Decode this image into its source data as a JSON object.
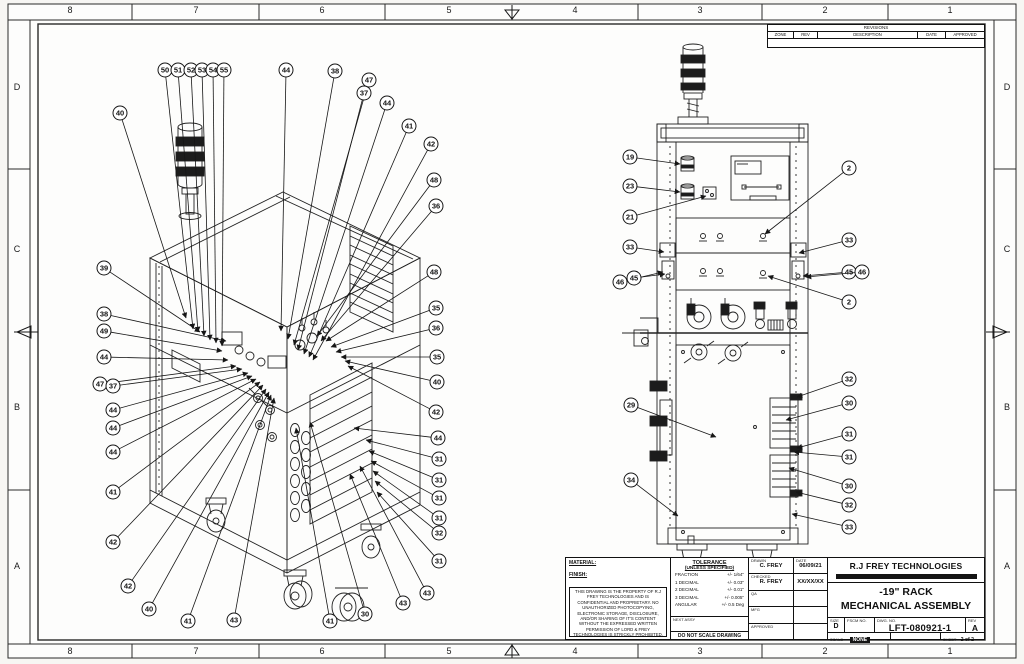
{
  "page": {
    "background": "#f7f6f3",
    "sheet_background": "#fdfdfc",
    "line_color": "#1b1b1b"
  },
  "border": {
    "top_zones": [
      "8",
      "7",
      "6",
      "5",
      "4",
      "3",
      "2",
      "1"
    ],
    "bottom_zones": [
      "8",
      "7",
      "6",
      "5",
      "4",
      "3",
      "2",
      "1"
    ],
    "left_rows": [
      "D",
      "C",
      "B",
      "A"
    ],
    "right_rows": [
      "D",
      "C",
      "B",
      "A"
    ]
  },
  "revisions": {
    "title": "REVISIONS",
    "columns": [
      "ZONE",
      "REV",
      "DESCRIPTION",
      "DATE",
      "APPROVED"
    ]
  },
  "title_block": {
    "material_label": "MATERIAL:",
    "finish_label": "FINISH:",
    "disclaimer": "THIS DRAWING IS THE PROPERTY OF R.J FREY TECHNOLOGIES AND IS CONFIDENTIAL AND PROPRIETARY. NO UNAUTHORIZED PHOTOCOPYING, ELECTRONIC STORAGE, DISCLOSURE, AND/OR SHARING OF IT'S CONTENT WITHOUT THE EXPRESSED WRITTEN PERMISSION OF LORD & FREY TECHNOLOGIES IS STRICKLY PROHIBITED.",
    "tolerance": {
      "title": "TOLERANCE",
      "subtitle": "(UNLESS SPECIFIED)",
      "rows": [
        {
          "name": "FRACTION",
          "value": "+/-  1/64\""
        },
        {
          "name": "1 DECIMAL",
          "value": "+/-  0.03\""
        },
        {
          "name": "2 DECIMAL",
          "value": "+/-  0.01\""
        },
        {
          "name": "3 DECIMAL",
          "value": "+/-  0.005\""
        },
        {
          "name": "ANGULAR",
          "value": "+/- 0.5 Deg"
        }
      ]
    },
    "next_assy_label": "NEXT ASSY",
    "do_not_scale": "DO NOT SCALE DRAWING",
    "date_label": "DATE",
    "approvals": [
      {
        "label": "DRAWN",
        "name": "C. FREY",
        "date": "06/09/21"
      },
      {
        "label": "CHECKED",
        "name": "R. FREY",
        "date": "XX/XX/XX"
      },
      {
        "label": "QA",
        "name": "",
        "date": ""
      },
      {
        "label": "MFG",
        "name": "",
        "date": ""
      },
      {
        "label": "APPROVED",
        "name": "",
        "date": ""
      }
    ],
    "company": "R.J FREY TECHNOLOGIES",
    "drawing_title_line1": "-19\" RACK",
    "drawing_title_line2": "MECHANICAL ASSEMBLY",
    "size_label": "SIZE",
    "size": "D",
    "fscm_label": "FSCM NO.",
    "dwg_no_label": "DWG. NO.",
    "dwg_no": "LFT-080921-1",
    "rev_label": "REV",
    "rev": "A",
    "scale_label": "SCALE",
    "scale": "NONE",
    "sheet_label": "SHEET",
    "sheet": "2 of 2"
  },
  "views": {
    "left_view": {
      "name": "isometric assembly view",
      "balloons": [
        {
          "n": "50",
          "x": 165,
          "y": 70,
          "ex": 193,
          "ey": 329
        },
        {
          "n": "51",
          "x": 178,
          "y": 70,
          "ex": 198,
          "ey": 332
        },
        {
          "n": "52",
          "x": 191,
          "y": 70,
          "ex": 204,
          "ey": 336
        },
        {
          "n": "53",
          "x": 202,
          "y": 70,
          "ex": 210,
          "ey": 340
        },
        {
          "n": "54",
          "x": 213,
          "y": 70,
          "ex": 216,
          "ey": 343
        },
        {
          "n": "55",
          "x": 224,
          "y": 70,
          "ex": 222,
          "ey": 346
        },
        {
          "n": "44",
          "x": 286,
          "y": 70,
          "ex": 281,
          "ey": 331
        },
        {
          "n": "38",
          "x": 335,
          "y": 71,
          "ex": 288,
          "ey": 339
        },
        {
          "n": "47",
          "x": 369,
          "y": 80,
          "ex": 294,
          "ey": 345
        },
        {
          "n": "37",
          "x": 364,
          "y": 93,
          "ex": 298,
          "ey": 350
        },
        {
          "n": "44",
          "x": 387,
          "y": 103,
          "ex": 304,
          "ey": 354
        },
        {
          "n": "41",
          "x": 409,
          "y": 126,
          "ex": 309,
          "ey": 357
        },
        {
          "n": "42",
          "x": 431,
          "y": 144,
          "ex": 313,
          "ey": 360
        },
        {
          "n": "48",
          "x": 434,
          "y": 180,
          "ex": 317,
          "ey": 336
        },
        {
          "n": "36",
          "x": 436,
          "y": 206,
          "ex": 321,
          "ey": 341
        },
        {
          "n": "40",
          "x": 120,
          "y": 113,
          "ex": 186,
          "ey": 318
        },
        {
          "n": "39",
          "x": 104,
          "y": 268,
          "ex": 200,
          "ey": 332
        },
        {
          "n": "38",
          "x": 104,
          "y": 314,
          "ex": 226,
          "ey": 341
        },
        {
          "n": "49",
          "x": 104,
          "y": 331,
          "ex": 222,
          "ey": 351
        },
        {
          "n": "44",
          "x": 104,
          "y": 357,
          "ex": 228,
          "ey": 360
        },
        {
          "n": "47",
          "x": 100,
          "y": 384,
          "ex": 236,
          "ey": 366
        },
        {
          "n": "37",
          "x": 113,
          "y": 386,
          "ex": 242,
          "ey": 369
        },
        {
          "n": "44",
          "x": 113,
          "y": 410,
          "ex": 248,
          "ey": 373
        },
        {
          "n": "44",
          "x": 113,
          "y": 428,
          "ex": 252,
          "ey": 376
        },
        {
          "n": "44",
          "x": 113,
          "y": 452,
          "ex": 256,
          "ey": 379
        },
        {
          "n": "41",
          "x": 113,
          "y": 492,
          "ex": 260,
          "ey": 382
        },
        {
          "n": "42",
          "x": 113,
          "y": 542,
          "ex": 263,
          "ey": 385
        },
        {
          "n": "42",
          "x": 128,
          "y": 586,
          "ex": 266,
          "ey": 389
        },
        {
          "n": "40",
          "x": 149,
          "y": 609,
          "ex": 269,
          "ey": 392
        },
        {
          "n": "41",
          "x": 188,
          "y": 621,
          "ex": 271,
          "ey": 395
        },
        {
          "n": "43",
          "x": 234,
          "y": 620,
          "ex": 274,
          "ey": 398
        },
        {
          "n": "41",
          "x": 330,
          "y": 621,
          "ex": 296,
          "ey": 428
        },
        {
          "n": "30",
          "x": 365,
          "y": 614,
          "ex": 310,
          "ey": 422
        },
        {
          "n": "43",
          "x": 403,
          "y": 603,
          "ex": 350,
          "ey": 474
        },
        {
          "n": "43",
          "x": 427,
          "y": 593,
          "ex": 360,
          "ey": 466
        },
        {
          "n": "48",
          "x": 434,
          "y": 272,
          "ex": 326,
          "ey": 341
        },
        {
          "n": "35",
          "x": 436,
          "y": 308,
          "ex": 331,
          "ey": 347
        },
        {
          "n": "36",
          "x": 436,
          "y": 328,
          "ex": 336,
          "ey": 352
        },
        {
          "n": "35",
          "x": 437,
          "y": 357,
          "ex": 341,
          "ey": 357
        },
        {
          "n": "40",
          "x": 437,
          "y": 382,
          "ex": 345,
          "ey": 361
        },
        {
          "n": "42",
          "x": 436,
          "y": 412,
          "ex": 348,
          "ey": 366
        },
        {
          "n": "44",
          "x": 438,
          "y": 438,
          "ex": 354,
          "ey": 428
        },
        {
          "n": "31",
          "x": 439,
          "y": 459,
          "ex": 366,
          "ey": 440
        },
        {
          "n": "31",
          "x": 439,
          "y": 480,
          "ex": 369,
          "ey": 451
        },
        {
          "n": "31",
          "x": 439,
          "y": 498,
          "ex": 371,
          "ey": 461
        },
        {
          "n": "31",
          "x": 439,
          "y": 518,
          "ex": 373,
          "ey": 471
        },
        {
          "n": "32",
          "x": 439,
          "y": 533,
          "ex": 375,
          "ey": 481
        },
        {
          "n": "31",
          "x": 439,
          "y": 561,
          "ex": 377,
          "ey": 492
        }
      ]
    },
    "right_view": {
      "name": "rear elevation view",
      "balloons": [
        {
          "n": "19",
          "x": 630,
          "y": 157,
          "ex": 680,
          "ey": 164
        },
        {
          "n": "23",
          "x": 630,
          "y": 186,
          "ex": 680,
          "ey": 192
        },
        {
          "n": "21",
          "x": 630,
          "y": 217,
          "ex": 706,
          "ey": 196
        },
        {
          "n": "2",
          "x": 849,
          "y": 168,
          "ex": 765,
          "ey": 234
        },
        {
          "n": "33",
          "x": 630,
          "y": 247,
          "ex": 664,
          "ey": 252
        },
        {
          "n": "33",
          "x": 849,
          "y": 240,
          "ex": 799,
          "ey": 253
        },
        {
          "n": "46",
          "x": 620,
          "y": 282,
          "ex": 663,
          "ey": 272
        },
        {
          "n": "45",
          "x": 634,
          "y": 278,
          "ex": 665,
          "ey": 274
        },
        {
          "n": "45",
          "x": 849,
          "y": 272,
          "ex": 803,
          "ey": 276
        },
        {
          "n": "46",
          "x": 862,
          "y": 272,
          "ex": 806,
          "ey": 277
        },
        {
          "n": "2",
          "x": 849,
          "y": 302,
          "ex": 768,
          "ey": 276
        },
        {
          "n": "32",
          "x": 849,
          "y": 379,
          "ex": 797,
          "ey": 397
        },
        {
          "n": "30",
          "x": 849,
          "y": 403,
          "ex": 786,
          "ey": 420
        },
        {
          "n": "29",
          "x": 631,
          "y": 405,
          "ex": 716,
          "ey": 437
        },
        {
          "n": "31",
          "x": 849,
          "y": 434,
          "ex": 797,
          "ey": 448
        },
        {
          "n": "31",
          "x": 849,
          "y": 457,
          "ex": 794,
          "ey": 452
        },
        {
          "n": "30",
          "x": 849,
          "y": 486,
          "ex": 789,
          "ey": 468
        },
        {
          "n": "32",
          "x": 849,
          "y": 505,
          "ex": 796,
          "ey": 492
        },
        {
          "n": "33",
          "x": 849,
          "y": 527,
          "ex": 792,
          "ey": 514
        },
        {
          "n": "34",
          "x": 631,
          "y": 480,
          "ex": 678,
          "ey": 516
        }
      ]
    }
  }
}
